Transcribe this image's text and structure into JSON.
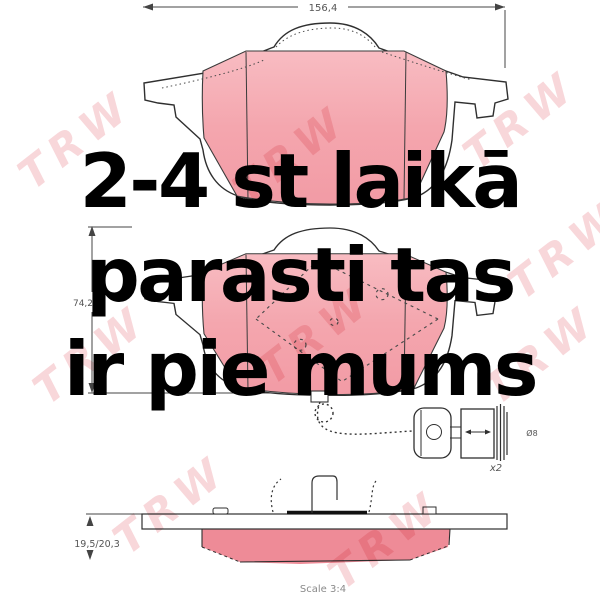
{
  "overlay": {
    "color": "#000000",
    "lines": [
      "2-4 st laikā",
      "parasti tas",
      "ir pie mums"
    ]
  },
  "watermark": {
    "text": "TRW",
    "color": "rgba(231,124,134,0.30)"
  },
  "drawing": {
    "width_dim": "156,4",
    "height_dim": "74,2",
    "thickness_dim": "19,5/20,3",
    "connector_qty": "x2",
    "connector_dia": "Ø8",
    "scale_note": "Scale 3:4",
    "colors": {
      "friction_pink": "#f4a6ae",
      "friction_pink_light": "#f8bcc2",
      "friction_pink_side": "#ee8b97",
      "line": "#2f2f2f"
    }
  }
}
